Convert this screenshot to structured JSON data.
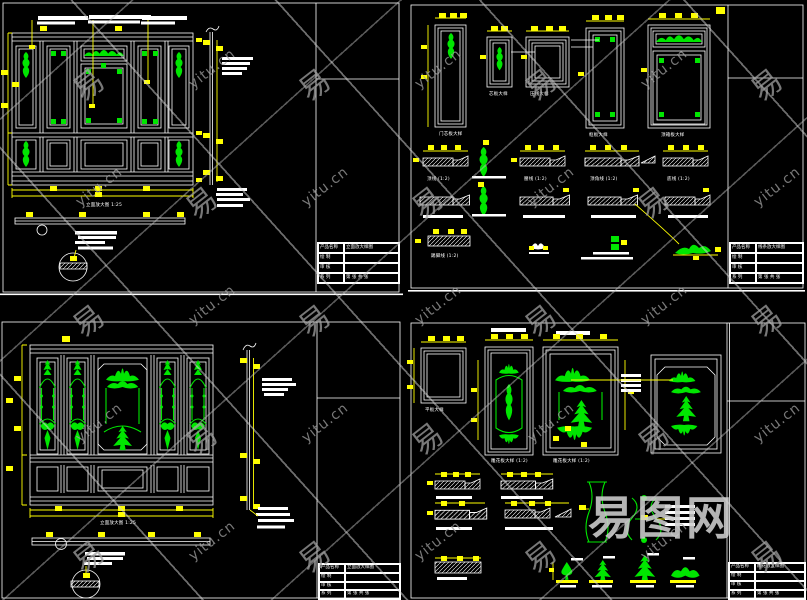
{
  "palette": {
    "background": "#000000",
    "line": "#ffffff",
    "dimension": "#ffff00",
    "carving": "#00e600",
    "watermark_gray": "#a0a0a0"
  },
  "watermark": {
    "site_text": "yitu.cn",
    "char_text": "易",
    "logo_text": "易图网",
    "grid": {
      "x0": 90,
      "y0": 77,
      "dx": 113,
      "dy": 118,
      "cols": 7,
      "rows": 5,
      "rotation_deg": -38
    }
  },
  "title_block": {
    "product_label": "产品名称",
    "drafter_label": "绘 制",
    "checker_label": "审 核",
    "series_label": "系 列",
    "page_label": "第 张 共 张"
  },
  "sheets": {
    "q1": {
      "title_value": "立面放大样图",
      "caption": "立面放大图 1:25"
    },
    "q2": {
      "title_value": "线条放大样图",
      "captions": [
        "门芯板大样",
        "芯板大样",
        "压线大样",
        "框板大样",
        "顶箱板大样",
        "顶线 (1:2)",
        "腰线 (1:2)",
        "顶角线 (1:2)",
        "底线 (1:2)",
        "踢脚线 (1:2)"
      ]
    },
    "q3": {
      "title_value": "立面放大样图",
      "caption": "立面放大图 1:25"
    },
    "q4": {
      "title_value": "雕花放大样图",
      "captions": [
        "平板大样",
        "雕花板大样 (1:2)",
        "雕花板大样 (1:2)"
      ]
    }
  }
}
